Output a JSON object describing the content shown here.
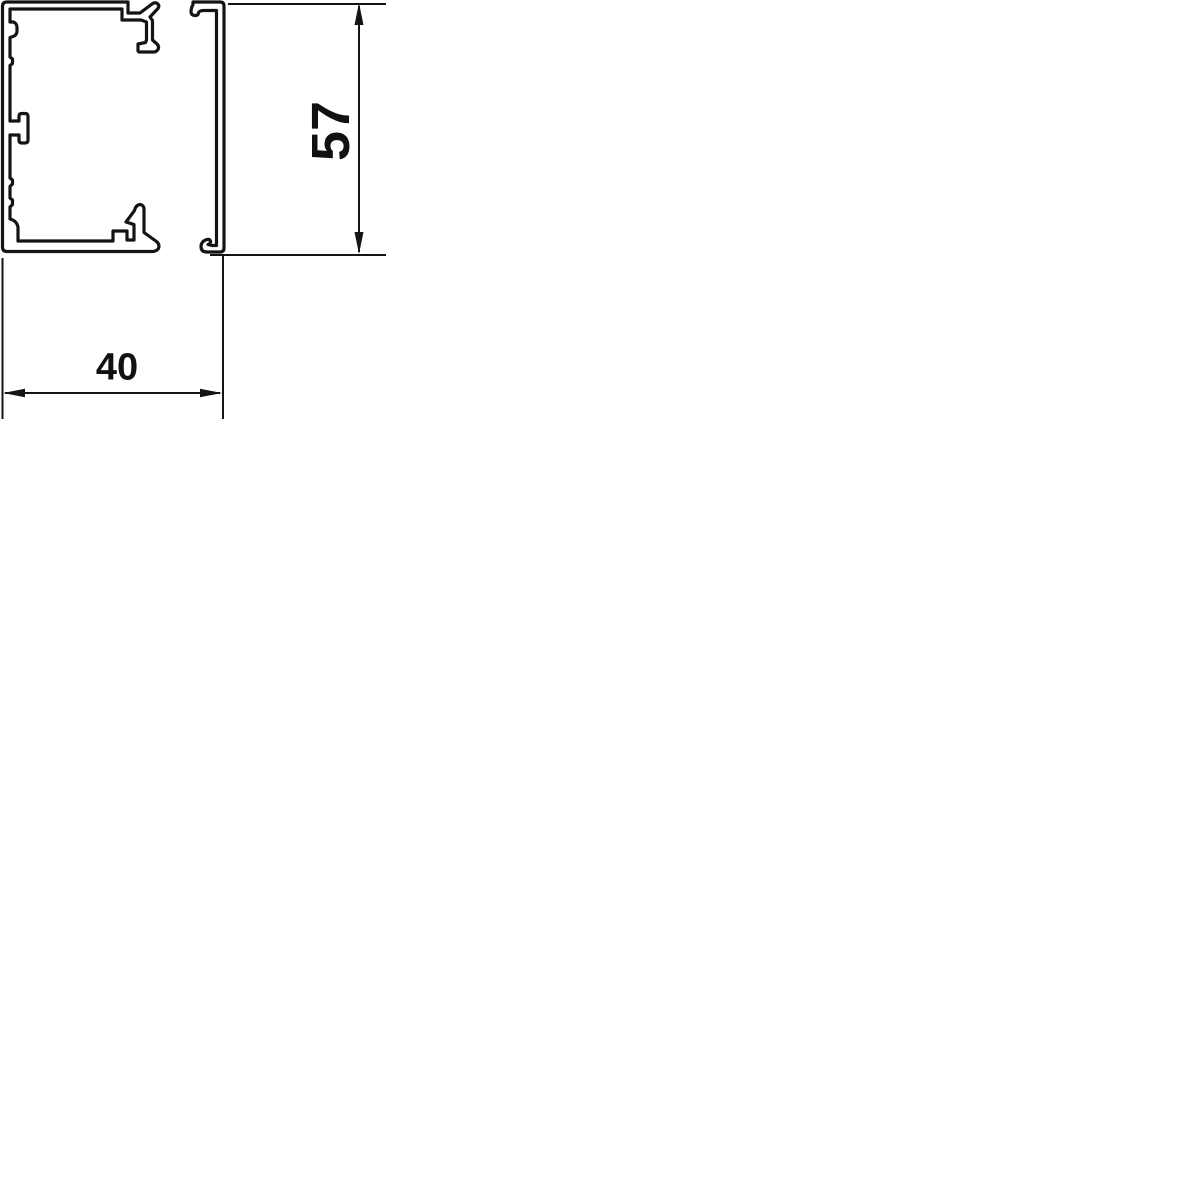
{
  "drawing": {
    "kind": "trunking-cross-section",
    "dimensions": {
      "height": {
        "label": "57"
      },
      "width": {
        "label": "40"
      }
    },
    "colors": {
      "line": "#141414",
      "text": "#111111",
      "background": "#ffffff"
    }
  }
}
